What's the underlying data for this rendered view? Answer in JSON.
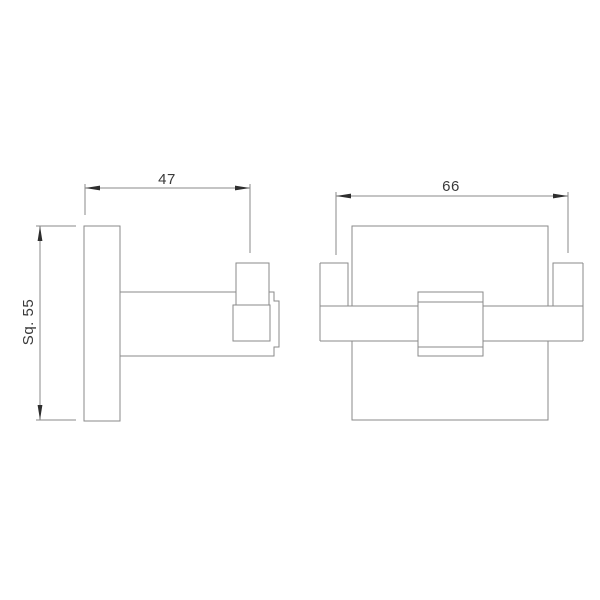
{
  "drawing": {
    "type": "technical-dimension-drawing",
    "subject": "square double robe hook, two orthographic views",
    "background": "#ffffff",
    "colors": {
      "outline": "#8a8a8a",
      "dimension_line": "#8a8a8a",
      "arrow": "#2e2e2e",
      "text": "#3a3a3a"
    },
    "views": {
      "side_view": {
        "name": "side view (left)",
        "parts": [
          "wall-plate",
          "arm",
          "hook-peg",
          "hook-face",
          "mount-flange"
        ]
      },
      "front_view": {
        "name": "front view (right)",
        "parts": [
          "back-plate",
          "cross-bar",
          "left-hook-peg",
          "right-hook-peg",
          "center-square-cap"
        ]
      }
    },
    "dimensions": {
      "side_projection": {
        "label": "47",
        "orientation": "horizontal"
      },
      "plate_size": {
        "label": "Sq. 55",
        "orientation": "vertical"
      },
      "hook_spread": {
        "label": "66",
        "orientation": "horizontal"
      }
    }
  }
}
